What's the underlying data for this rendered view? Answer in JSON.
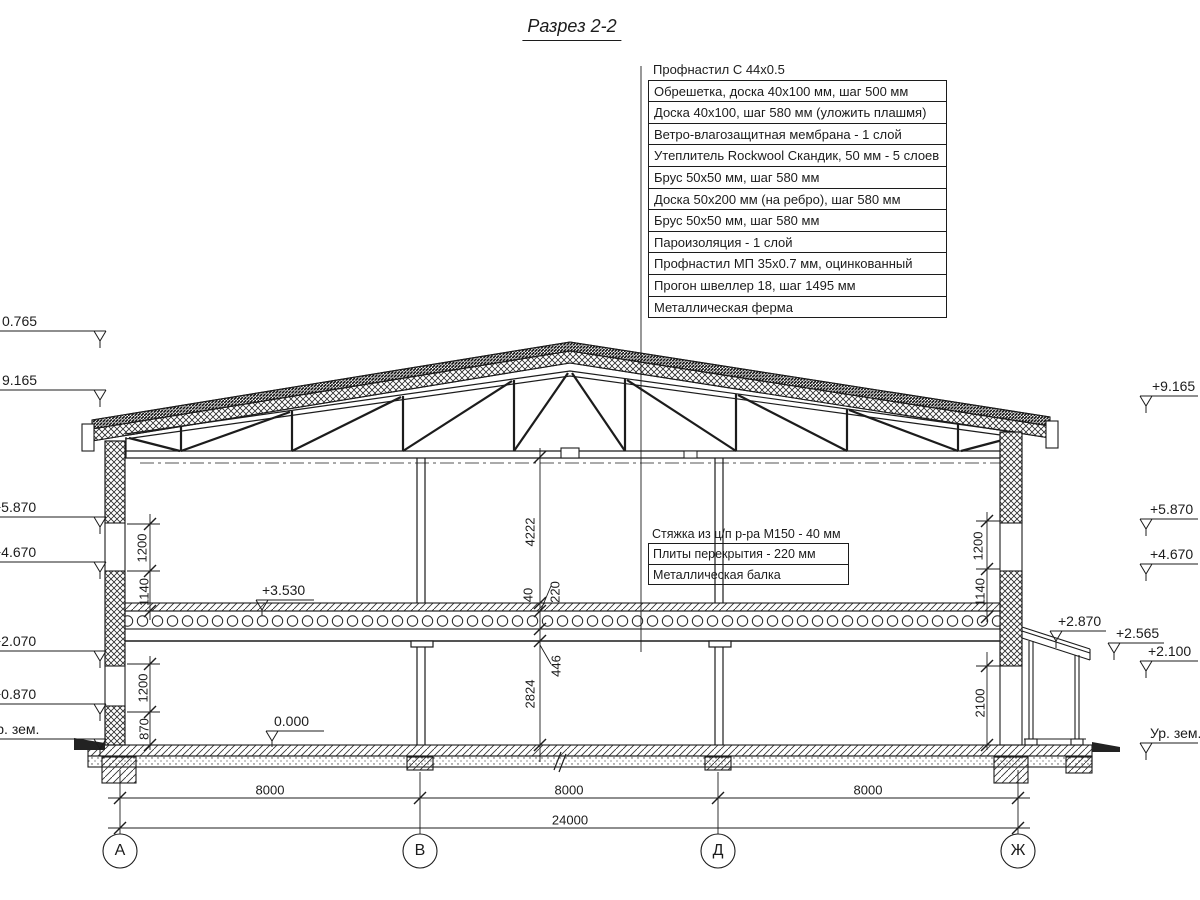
{
  "title": "Разрез 2-2",
  "roof_callouts": [
    "Профнастил С 44х0.5",
    "Обрешетка, доска 40х100 мм, шаг 500 мм",
    "Доска 40х100, шаг 580 мм (уложить плашмя)",
    "Ветро-влагозащитная мембрана - 1 слой",
    "Утеплитель Rockwool Скандик, 50 мм - 5 слоев",
    "Брус 50х50 мм, шаг 580 мм",
    "Доска 50х200 мм (на ребро), шаг 580 мм",
    "Брус 50х50 мм, шаг 580 мм",
    "Пароизоляция - 1 слой",
    "Профнастил МП 35х0.7 мм, оцинкованный",
    "Прогон швеллер 18, шаг 1495 мм",
    "Металлическая ферма"
  ],
  "floor_callouts": [
    "Стяжка из ц/п р-ра М150 - 40 мм",
    "Плиты перекрытия - 220 мм",
    "Металлическая балка"
  ],
  "left_marks": {
    "m0": "0.765",
    "m1": "9.165",
    "m2": "+5.870",
    "m3": "+4.670",
    "m4": "+2.070",
    "m5": "+0.870",
    "ground": "Ур. зем."
  },
  "right_marks": {
    "m1": "+9.165",
    "m2": "+5.870",
    "m3": "+4.670",
    "m4": "+2.870",
    "m5": "+2.565",
    "m6": "+2.100",
    "ground": "Ур. зем."
  },
  "levels": {
    "second_floor": "+3.530",
    "first_floor": "0.000"
  },
  "dims": {
    "chain_center": {
      "d1": "4222",
      "d2": "40",
      "d3": "220",
      "d4": "446",
      "d5": "2824"
    },
    "left_upper": {
      "d1": "1200",
      "d2": "1140"
    },
    "left_lower": {
      "d1": "1200",
      "d2": "870"
    },
    "right_upper": {
      "d1": "1200",
      "d2": "1140"
    },
    "right_lower": {
      "d1": "2100"
    },
    "spans": {
      "s1": "8000",
      "s2": "8000",
      "s3": "8000",
      "total": "24000"
    }
  },
  "axes": {
    "a": "А",
    "b": "В",
    "d": "Д",
    "zh": "Ж"
  }
}
